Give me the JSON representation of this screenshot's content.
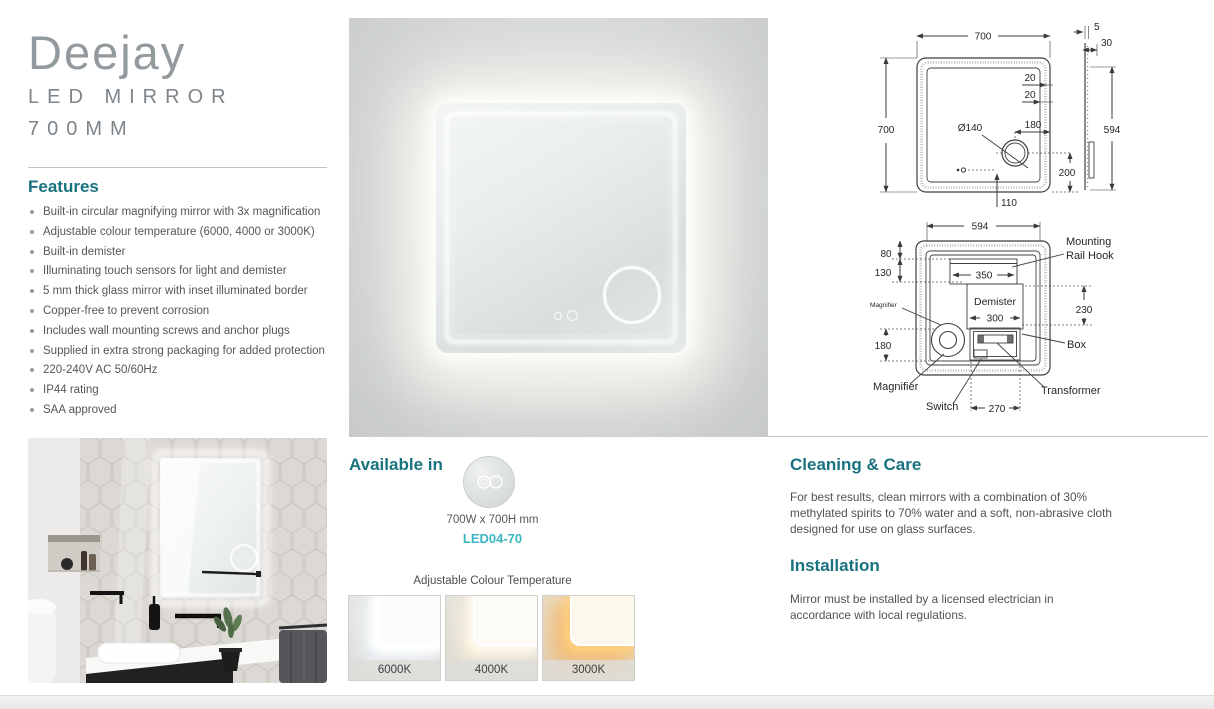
{
  "brand": {
    "product_name": "Deejay",
    "product_type": "LED MIRROR",
    "product_size": "700MM"
  },
  "features": {
    "heading": "Features",
    "items": [
      "Built-in circular magnifying mirror with 3x magnification",
      "Adjustable colour temperature (6000, 4000 or 3000K)",
      "Built-in demister",
      "Illuminating touch sensors for light and demister",
      "5 mm thick glass mirror with inset illuminated border",
      "Copper-free to prevent corrosion",
      "Includes wall mounting screws and anchor plugs",
      "Supplied in extra strong packaging for added protection",
      "220-240V AC 50/60Hz",
      "IP44 rating",
      "SAA approved"
    ]
  },
  "available": {
    "heading": "Available in",
    "dimensions": "700W x 700H mm",
    "model_code": "LED04-70",
    "colour_temp_heading": "Adjustable Colour Temperature",
    "temps": [
      "6000K",
      "4000K",
      "3000K"
    ]
  },
  "cleaning_care": {
    "heading": "Cleaning & Care",
    "body": "For best results, clean mirrors with a combination of 30% methylated spirits to 70% water and a soft, non-abrasive cloth designed for use on glass surfaces."
  },
  "installation": {
    "heading": "Installation",
    "body": "Mirror must be installed by a licensed electrician in accordance with local regulations."
  },
  "diagram_front": {
    "width": "700",
    "height": "700",
    "border_inset_1": "20",
    "border_inset_2": "20",
    "magnifier_diameter": "Ø140",
    "magnifier_offset_right": "180",
    "magnifier_offset_bottom": "200",
    "sensor_offset_bottom": "110",
    "side_thickness": "5",
    "side_depth": "30",
    "side_mount_height": "594"
  },
  "diagram_rear": {
    "mirror_width": "594",
    "hook_offset_top": "80",
    "rail_offset": "130",
    "rail_width": "350",
    "demister_label": "Demister",
    "demister_width": "300",
    "right_span": "230",
    "magnifier_offset": "180",
    "bottom_span": "270",
    "mounting_label_1": "Mounting",
    "mounting_label_2": "Rail Hook",
    "magnifier_label_small": "Magnifier",
    "magnifier_label": "Magnifier",
    "switch_label": "Switch",
    "box_label": "Box",
    "transformer_label": "Transformer"
  },
  "colors": {
    "accent_teal": "#18737e",
    "accent_cyan": "#3cb6c3"
  }
}
